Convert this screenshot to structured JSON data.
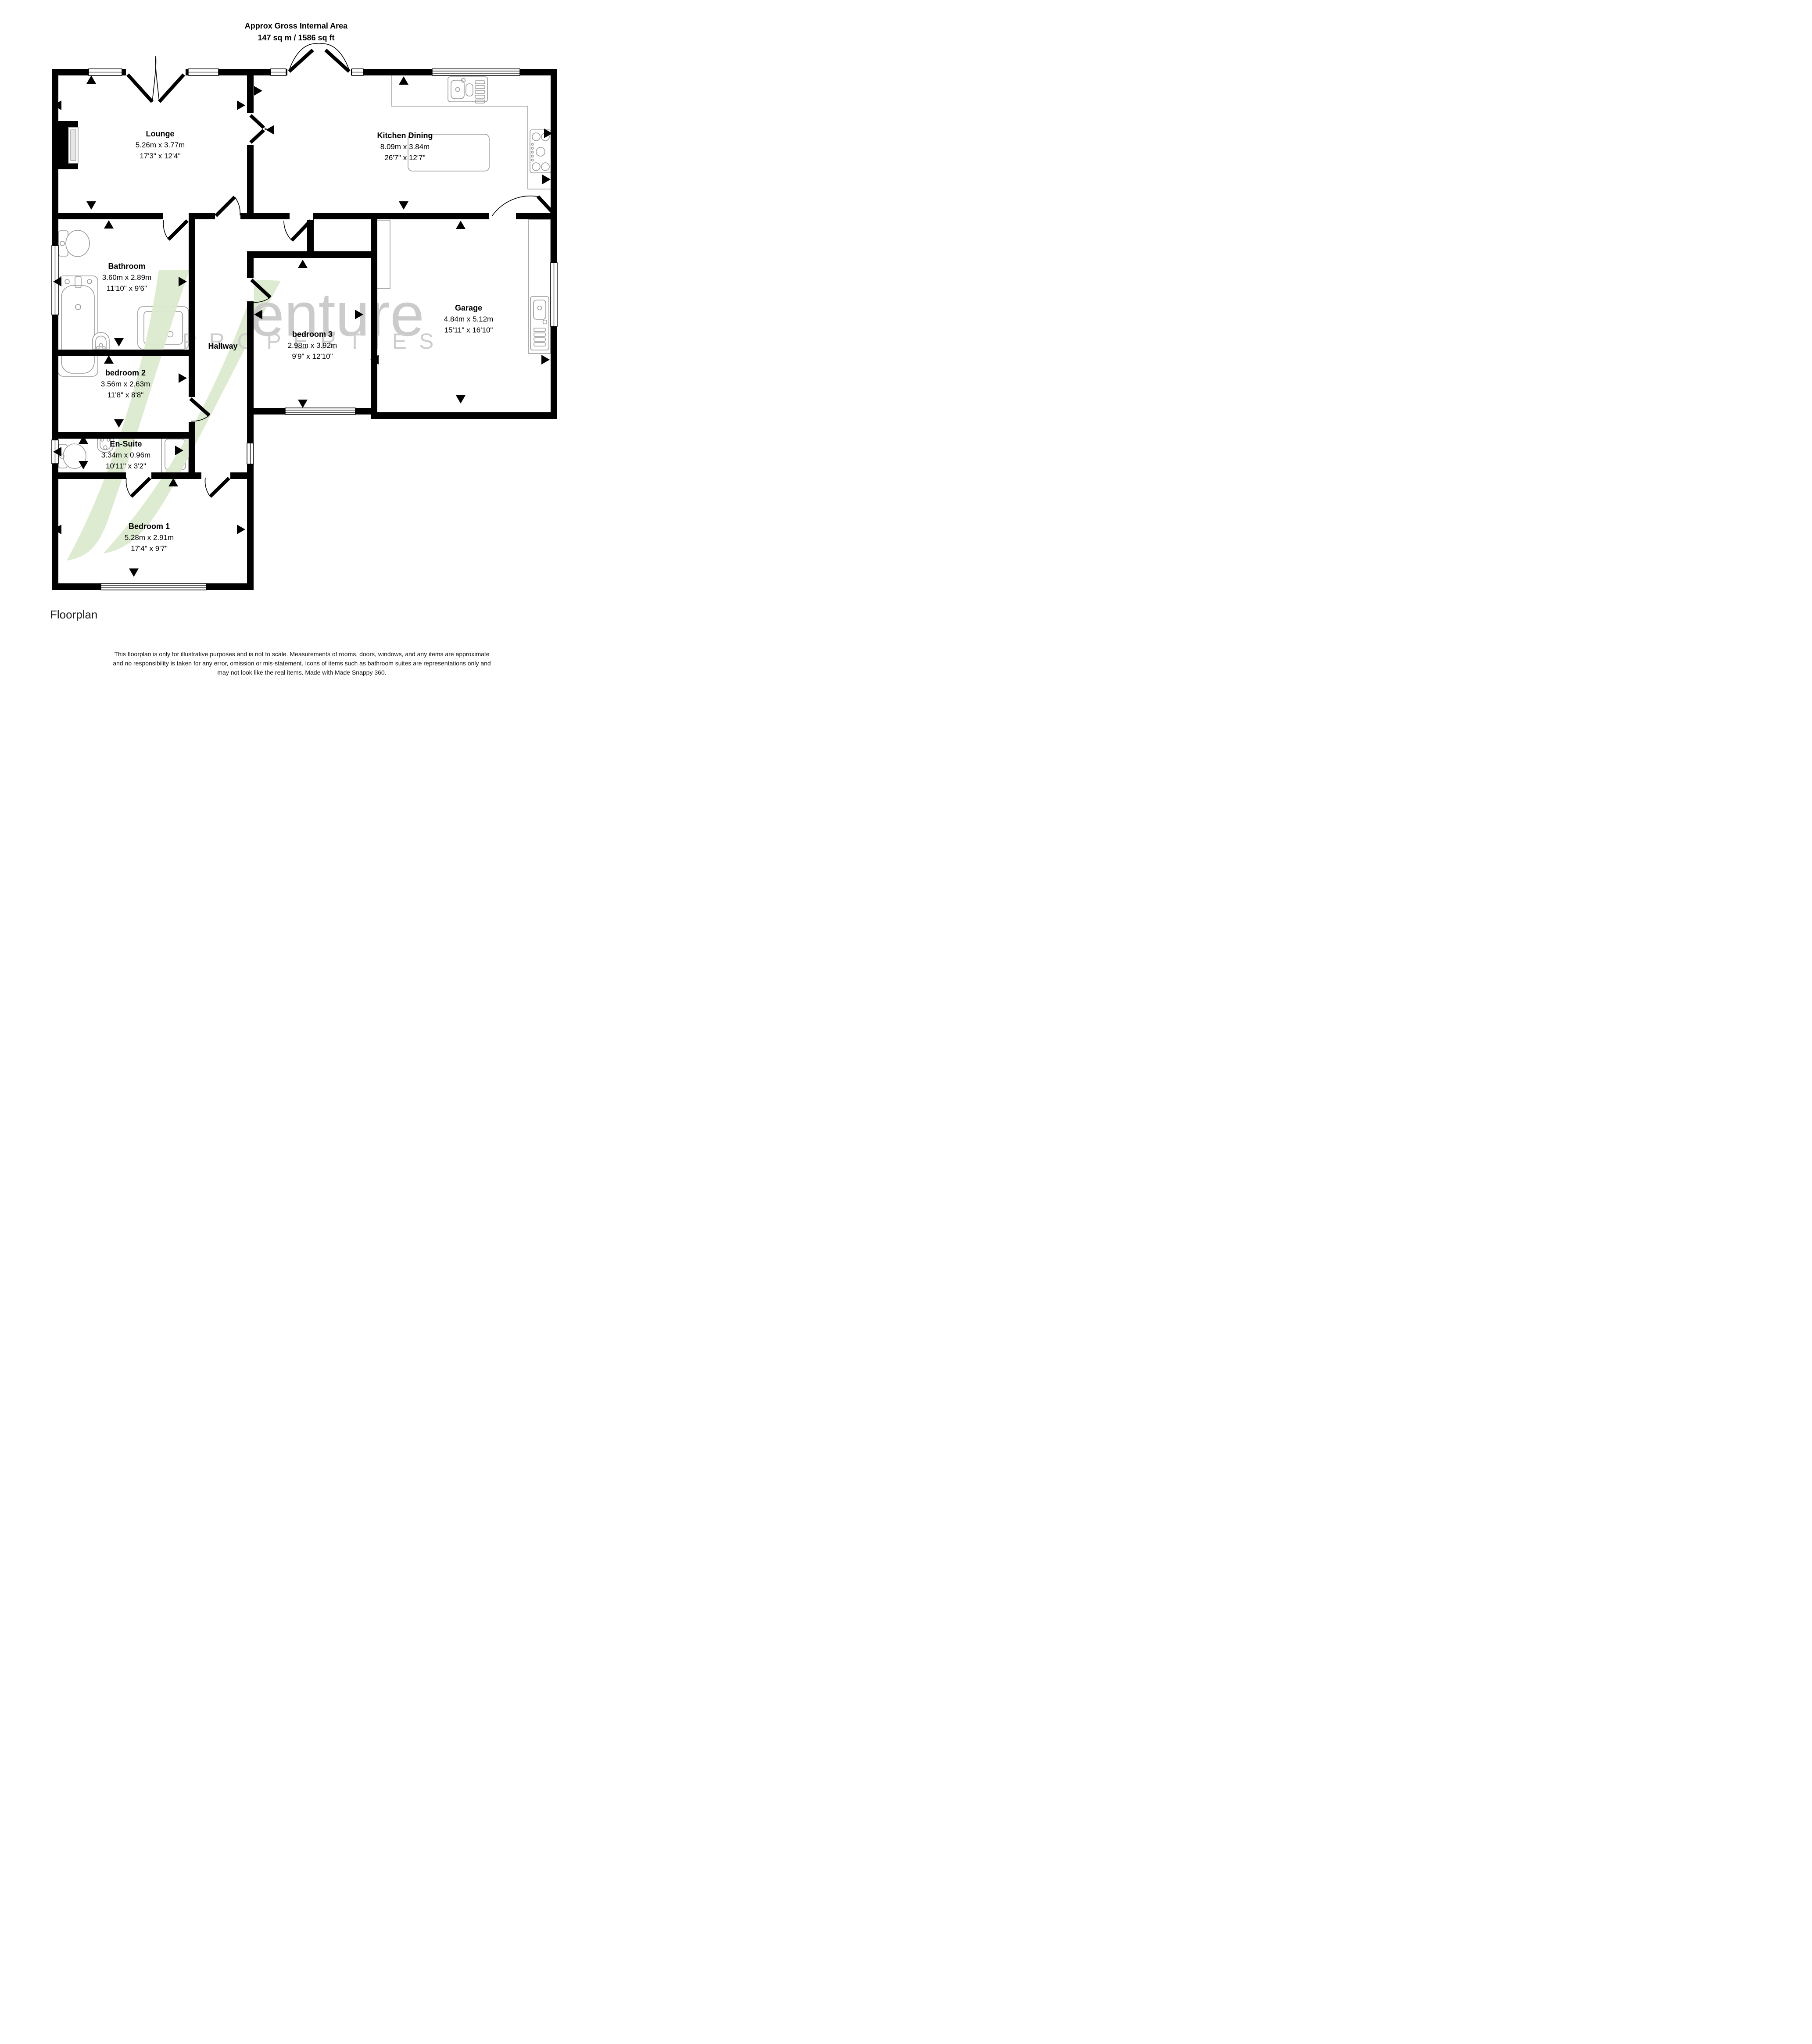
{
  "title": {
    "line1": "Approx Gross Internal Area",
    "line2": "147 sq m / 1586 sq ft"
  },
  "rooms": [
    {
      "name": "Lounge",
      "metric": "5.26m x 3.77m",
      "imperial": "17'3\" x 12'4\""
    },
    {
      "name": "Kitchen Dining",
      "metric": "8.09m x 3.84m",
      "imperial": "26'7\" x 12'7\""
    },
    {
      "name": "Bathroom",
      "metric": "3.60m x 2.89m",
      "imperial": "11'10\" x 9'6\""
    },
    {
      "name": "Hallway"
    },
    {
      "name": "bedroom 3",
      "metric": "2.98m x 3.92m",
      "imperial": "9'9\" x 12'10\""
    },
    {
      "name": "Garage",
      "metric": "4.84m x 5.12m",
      "imperial": "15'11\" x 16'10\""
    },
    {
      "name": "bedroom 2",
      "metric": "3.56m x 2.63m",
      "imperial": "11'8\" x 8'8\""
    },
    {
      "name": "En-Suite",
      "metric": "3.34m x 0.96m",
      "imperial": "10'11\" x 3'2\""
    },
    {
      "name": "Bedroom 1",
      "metric": "5.28m x 2.91m",
      "imperial": "17'4\" x 9'7\""
    }
  ],
  "watermark": {
    "brand": "Venture",
    "brand_tail": "enture",
    "subtitle": "PROPERTIES",
    "accent_green": "#dcebcf",
    "text_gray": "#c9c9c9"
  },
  "footer": {
    "caption": "Floorplan",
    "disclaimer_line1": "This floorplan is only for illustrative purposes and is not to scale. Measurements of rooms, doors, windows, and any items are approximate",
    "disclaimer_line2": "and no responsibility is taken for any error, omission or mis-statement. Icons of items such as bathroom suites are representations only and",
    "disclaimer_line3": "may not look like the real items. Made with Made Snappy 360."
  }
}
